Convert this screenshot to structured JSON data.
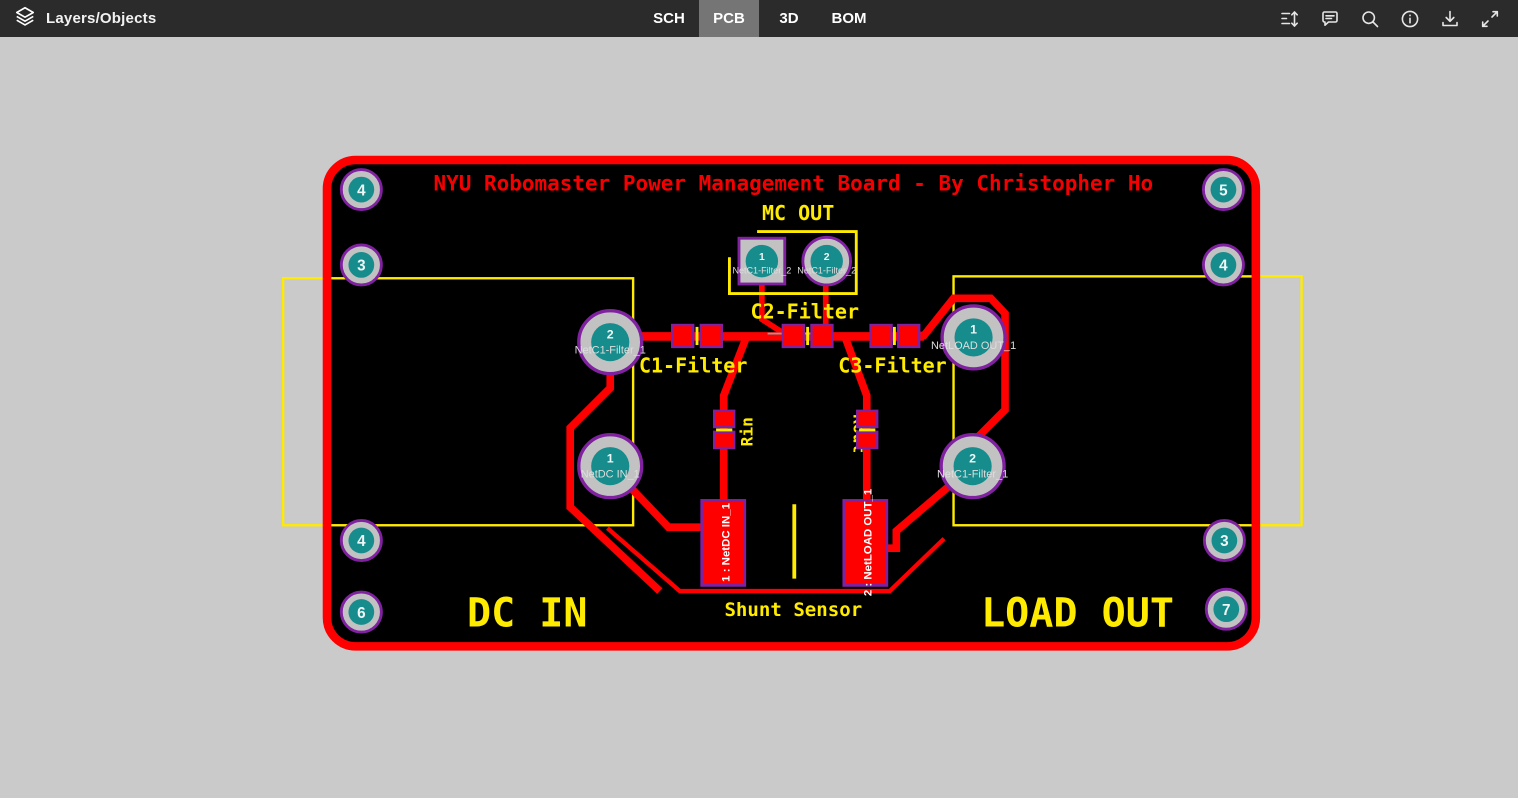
{
  "toolbar": {
    "layers_label": "Layers/Objects",
    "tabs": [
      {
        "label": "SCH",
        "active": false
      },
      {
        "label": "PCB",
        "active": true
      },
      {
        "label": "3D",
        "active": false
      },
      {
        "label": "BOM",
        "active": false
      }
    ],
    "icons": [
      "measure-icon",
      "comment-icon",
      "search-icon",
      "info-icon",
      "download-icon",
      "fullscreen-icon"
    ]
  },
  "board": {
    "title": "NYU Robomaster Power Management Board - By Christopher Ho",
    "labels": {
      "mc_out": "MC OUT",
      "c1": "C1-Filter",
      "c2": "C2-Filter",
      "c3": "C3-Filter",
      "rin": "Rin",
      "rout": "Rout",
      "shunt": "Shunt Sensor",
      "dc_in": "DC IN",
      "load_out": "LOAD OUT"
    },
    "mc_pads": [
      {
        "num": "1",
        "net": "NetC1-Filter_2"
      },
      {
        "num": "2",
        "net": "NetC1-Filter_2"
      }
    ],
    "through_pads": [
      {
        "num": "2",
        "net": "NetC1-Filter_1"
      },
      {
        "num": "1",
        "net": "NetDC IN_1"
      },
      {
        "num": "1",
        "net": "NetLOAD OUT_1"
      },
      {
        "num": "2",
        "net": "NetC1-Filter_1"
      }
    ],
    "shunt_pads": [
      {
        "label": "1 : NetDC IN_1"
      },
      {
        "label": "2 : NetLOAD OUT_1"
      }
    ],
    "corner_pads": [
      "4",
      "3",
      "4",
      "6",
      "5",
      "4",
      "3",
      "7"
    ],
    "colors": {
      "board_outline": "#ff0000",
      "copper": "#ff0000",
      "silkscreen": "#ffeb00",
      "title_red": "#f40000",
      "pad_ring": "#8021a0",
      "pad_drill": "#178c8c",
      "pad_body": "#c2c2c2",
      "toolbar_bg": "#2b2b2b",
      "active_tab_bg": "#757575",
      "canvas_bg": "#cacaca"
    }
  }
}
